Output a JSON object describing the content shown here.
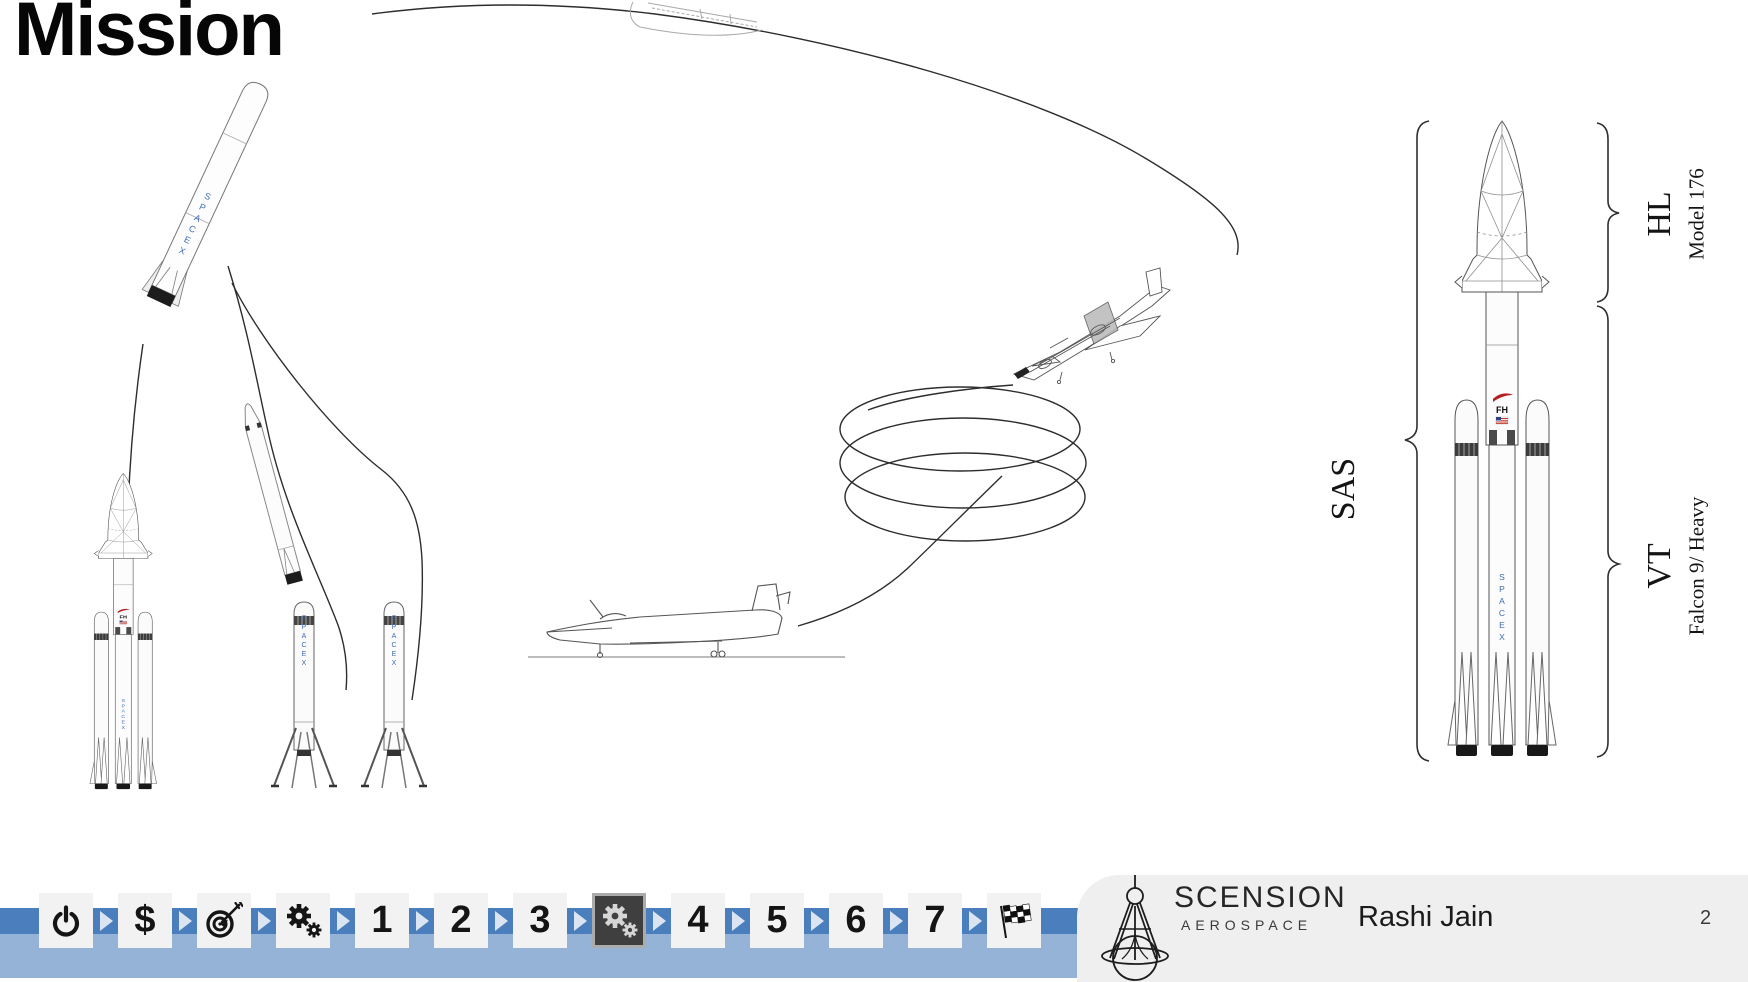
{
  "slide": {
    "title": "Mission"
  },
  "diagram": {
    "system_label": "SAS",
    "upper_stage": {
      "abbr": "HL",
      "model": "Model 176"
    },
    "lower_stage": {
      "abbr": "VT",
      "model": "Falcon 9/ Heavy"
    },
    "markings": {
      "vehicle": "FH",
      "brand": "SPACEX"
    }
  },
  "nav": {
    "items": [
      {
        "id": "power",
        "icon": "power-icon",
        "label": ""
      },
      {
        "id": "dollar",
        "label": "$"
      },
      {
        "id": "target",
        "icon": "target-icon",
        "label": ""
      },
      {
        "id": "gears-setup",
        "icon": "gears-icon",
        "label": ""
      },
      {
        "id": "section-1",
        "label": "1"
      },
      {
        "id": "section-2",
        "label": "2"
      },
      {
        "id": "section-3",
        "label": "3"
      },
      {
        "id": "gears-current",
        "icon": "gears-icon",
        "label": "",
        "selected": true
      },
      {
        "id": "section-4",
        "label": "4"
      },
      {
        "id": "section-5",
        "label": "5"
      },
      {
        "id": "section-6",
        "label": "6"
      },
      {
        "id": "section-7",
        "label": "7"
      },
      {
        "id": "finish-flag",
        "icon": "checkered-flag-icon",
        "label": ""
      }
    ]
  },
  "footer": {
    "brand_main": "SCENSION",
    "brand_sub": "AEROSPACE",
    "author": "Rashi Jain",
    "page_number": "2"
  },
  "colors": {
    "band_dark": "#4a7ebc",
    "band_light": "#95b3d7",
    "tile_bg": "#f2f2f2",
    "tile_selected_bg": "#3f3f3f",
    "brand_blue": "#3f6ab5",
    "accent_red": "#b51f24",
    "footer_bg": "#efefef"
  }
}
